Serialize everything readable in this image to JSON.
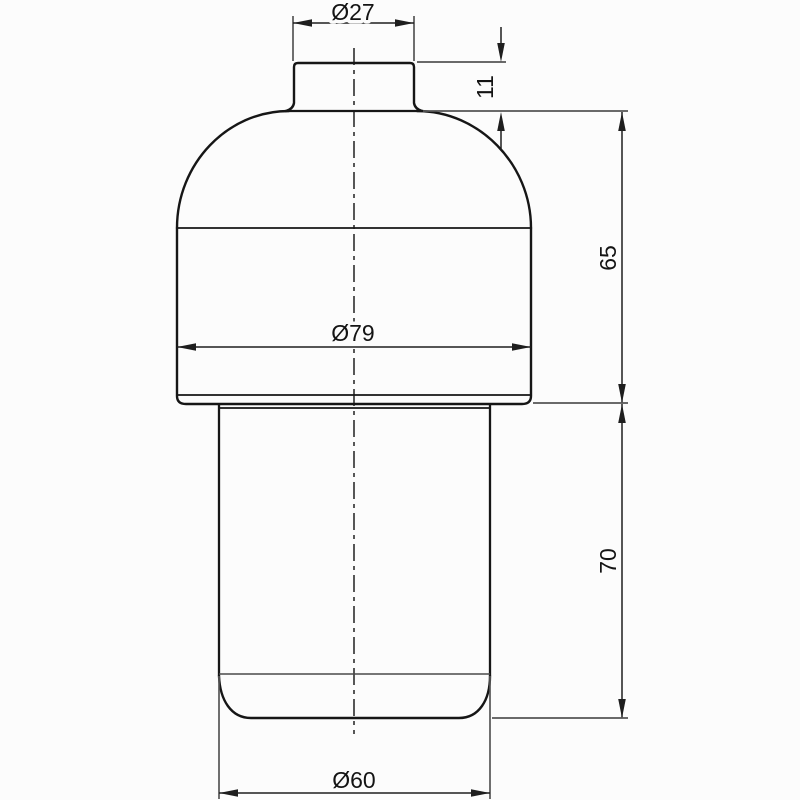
{
  "drawing": {
    "dimensions": {
      "top_diameter": "Ø27",
      "neck_height": "11",
      "upper_height": "65",
      "body_diameter": "Ø79",
      "lower_height": "70",
      "bottom_diameter": "Ø60"
    },
    "colors": {
      "background": "#fcfcfc",
      "outline": "#161616",
      "dimension_line": "#1e1e1e",
      "extension_line": "#565656"
    }
  }
}
